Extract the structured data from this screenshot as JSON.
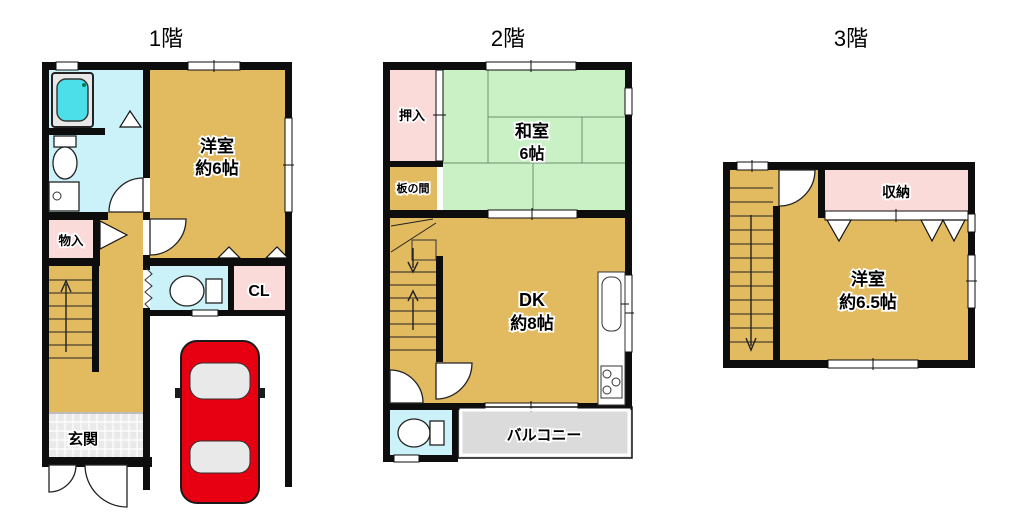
{
  "colors": {
    "wall": "#0d0d0d",
    "room_tan": "#e2ba60",
    "tatami_green": "#caf0c6",
    "closet_pink": "#fbdada",
    "water_cyan": "#cbf2f8",
    "tub_cyan": "#4cdfe9",
    "balcony_gray": "#dbdbdb",
    "genkan_gray": "#eaeaea",
    "garage_white": "#ffffff",
    "car_red": "#e60012"
  },
  "floors": [
    {
      "title": "1階",
      "rooms": {
        "western_room": {
          "name": "洋室",
          "size": "約6帖"
        },
        "storage": {
          "label": "物入"
        },
        "closet": {
          "label": "CL"
        },
        "entrance": {
          "label": "玄関"
        }
      }
    },
    {
      "title": "2階",
      "rooms": {
        "oshiire": {
          "label": "押入"
        },
        "japanese_room": {
          "name": "和室",
          "size": "6帖"
        },
        "itanoma": {
          "label": "板の間"
        },
        "dining_kitchen": {
          "name": "DK",
          "size": "約8帖"
        },
        "balcony": {
          "label": "バルコニー"
        }
      }
    },
    {
      "title": "3階",
      "rooms": {
        "storage": {
          "label": "収納"
        },
        "western_room": {
          "name": "洋室",
          "size": "約6.5帖"
        }
      }
    }
  ]
}
